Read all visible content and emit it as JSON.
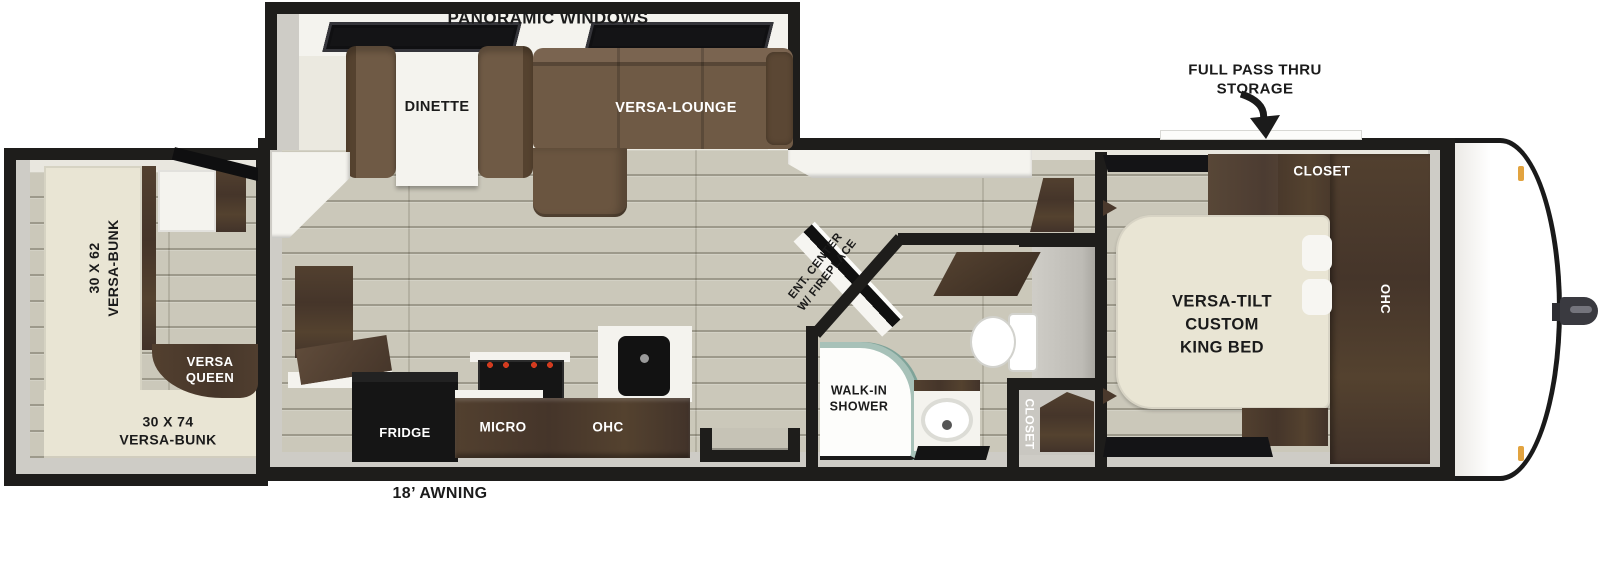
{
  "meta": {
    "title": "Travel trailer floor plan with rear bunk room, panoramic windows slide-out and front king bedroom"
  },
  "colors": {
    "wall": "#1e1d1b",
    "floor": "#cbc8ba",
    "wall-face": "#ceccc6",
    "wall-face-light": "#e9e7df",
    "cream": "#ebe9e0",
    "white-surface": "#f4f3ee",
    "sofa": "#6f5a45",
    "cabinet": "#4a392c",
    "bed": "#e9e5d4",
    "appliance": "#151515",
    "glass": "#a7c1b8",
    "amber": "#e2a33f",
    "metal": "#3a3a40",
    "text-dark": "#1b1b1b",
    "text-light": "#ffffff"
  },
  "labels": {
    "panoramic_windows": "PANORAMIC WINDOWS",
    "full_pass_thru_storage": "FULL PASS THRU\nSTORAGE",
    "awning": "18’ AWNING",
    "dinette": "DINETTE",
    "versa_lounge": "VERSA-LOUNGE",
    "ent_center_fireplace": "ENT. CENTER\nW/ FIREPLACE",
    "fridge": "FRIDGE",
    "micro": "MICRO",
    "kitchen_ohc": "OHC",
    "walk_in_shower": "WALK-IN\nSHOWER",
    "bath_closet": "CLOSET",
    "bedroom_closet": "CLOSET",
    "bedroom_ohc": "OHC",
    "king_bed": "VERSA-TILT\nCUSTOM\nKING BED",
    "side_bunk": "30 X 62\nVERSA-BUNK",
    "versa_queen": "VERSA\nQUEEN",
    "rear_bunk": "30 X 74\nVERSA-BUNK"
  }
}
